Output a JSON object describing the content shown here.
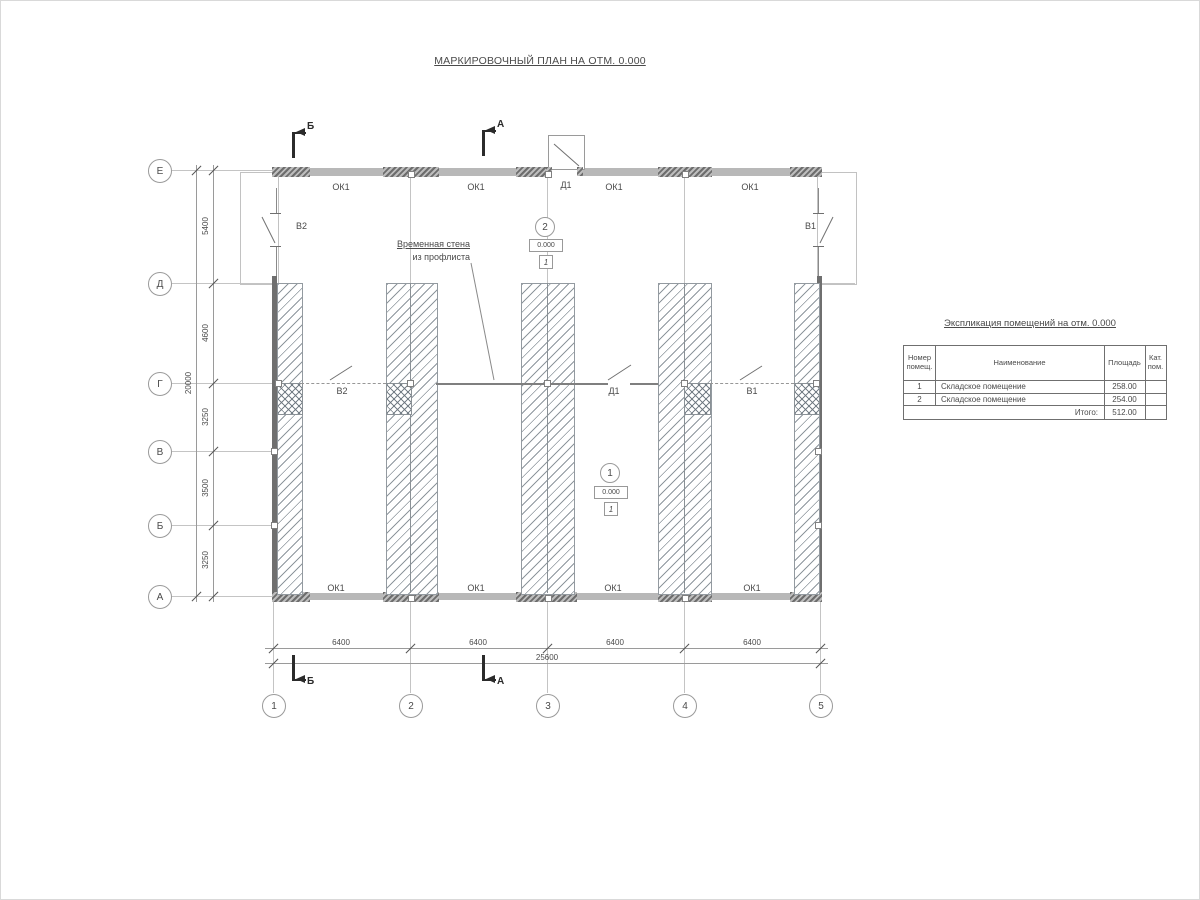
{
  "title": "МАРКИРОВОЧНЫЙ ПЛАН НА ОТМ. 0.000",
  "plan": {
    "row_axes": [
      "Е",
      "Д",
      "Г",
      "В",
      "Б",
      "А"
    ],
    "col_axes": [
      "1",
      "2",
      "3",
      "4",
      "5"
    ],
    "dims_left": [
      "5400",
      "4600",
      "3250",
      "3500",
      "3250"
    ],
    "dim_total_left": "20000",
    "dims_bottom": [
      "6400",
      "6400",
      "6400",
      "6400"
    ],
    "dim_total_bottom": "25600",
    "sections": {
      "a": "А",
      "b": "Б"
    },
    "window_label": "ОК1",
    "door_label": "Д1",
    "gate1_label": "В1",
    "gate2_label": "В2",
    "annotation_line1": "Временная стена",
    "annotation_line2": "из профлиста",
    "rooms": [
      {
        "num": "1",
        "level": "0.000",
        "floor": "1"
      },
      {
        "num": "2",
        "level": "0.000",
        "floor": "1"
      }
    ]
  },
  "schedule": {
    "title": "Экспликация помещений на отм. 0.000",
    "col_num": "Номер помещ.",
    "col_name": "Наименование",
    "col_area": "Площадь",
    "col_cat": "Кат. пом.",
    "rows": [
      {
        "num": "1",
        "name": "Складское помещение",
        "area": "258.00",
        "cat": ""
      },
      {
        "num": "2",
        "name": "Складское помещение",
        "area": "254.00",
        "cat": ""
      }
    ],
    "total_label": "Итого:",
    "total_value": "512.00"
  }
}
